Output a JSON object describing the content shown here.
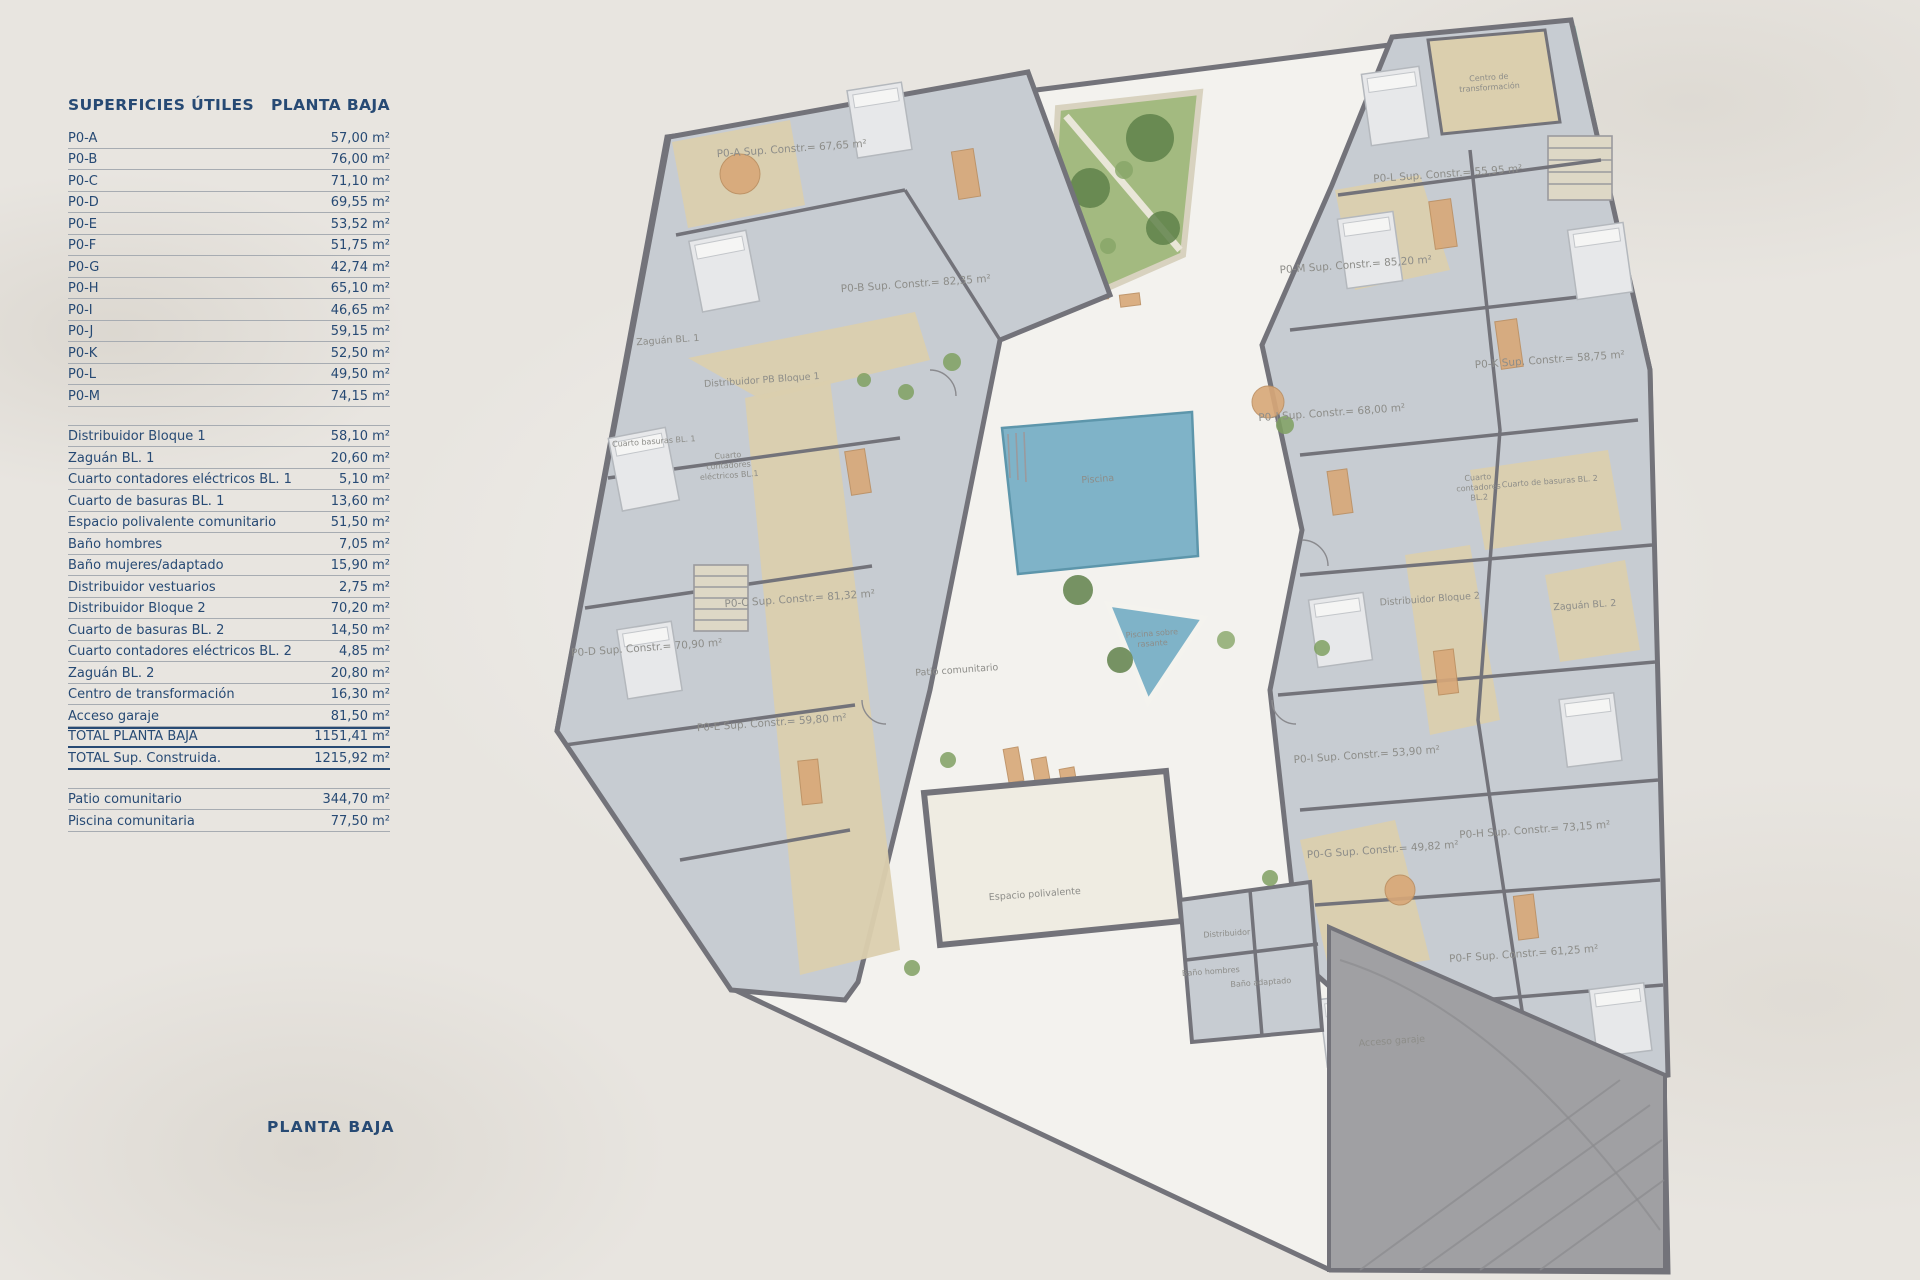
{
  "panel": {
    "title": "SUPERFICIES ÚTILES",
    "subtitle": "PLANTA BAJA",
    "apartments": [
      {
        "label": "P0-A",
        "value": "57,00 m²"
      },
      {
        "label": "P0-B",
        "value": "76,00 m²"
      },
      {
        "label": "P0-C",
        "value": "71,10 m²"
      },
      {
        "label": "P0-D",
        "value": "69,55 m²"
      },
      {
        "label": "P0-E",
        "value": "53,52 m²"
      },
      {
        "label": "P0-F",
        "value": "51,75 m²"
      },
      {
        "label": "P0-G",
        "value": "42,74 m²"
      },
      {
        "label": "P0-H",
        "value": "65,10 m²"
      },
      {
        "label": "P0-I",
        "value": "46,65 m²"
      },
      {
        "label": "P0-J",
        "value": "59,15 m²"
      },
      {
        "label": "P0-K",
        "value": "52,50 m²"
      },
      {
        "label": "P0-L",
        "value": "49,50 m²"
      },
      {
        "label": "P0-M",
        "value": "74,15 m²"
      }
    ],
    "common": [
      {
        "label": "Distribuidor Bloque 1",
        "value": "58,10 m²"
      },
      {
        "label": "Zaguán BL. 1",
        "value": "20,60 m²"
      },
      {
        "label": "Cuarto contadores eléctricos BL. 1",
        "value": "5,10 m²"
      },
      {
        "label": "Cuarto de basuras BL. 1",
        "value": "13,60 m²"
      },
      {
        "label": "Espacio polivalente comunitario",
        "value": "51,50 m²"
      },
      {
        "label": "Baño hombres",
        "value": "7,05 m²"
      },
      {
        "label": "Baño mujeres/adaptado",
        "value": "15,90 m²"
      },
      {
        "label": "Distribuidor vestuarios",
        "value": "2,75 m²"
      },
      {
        "label": "Distribuidor Bloque 2",
        "value": "70,20 m²"
      },
      {
        "label": "Cuarto de basuras BL. 2",
        "value": "14,50 m²"
      },
      {
        "label": "Cuarto contadores eléctricos BL. 2",
        "value": "4,85 m²"
      },
      {
        "label": "Zaguán BL. 2",
        "value": "20,80 m²"
      },
      {
        "label": "Centro de transformación",
        "value": "16,30 m²"
      },
      {
        "label": "Acceso garaje",
        "value": "81,50 m²"
      },
      {
        "label": "TOTAL PLANTA BAJA",
        "value": "1151,41 m²",
        "strong": true,
        "topline": true
      },
      {
        "label": "TOTAL Sup. Construida.",
        "value": "1215,92 m²",
        "strong": true
      }
    ],
    "outdoor": [
      {
        "label": "Patio comunitario",
        "value": "344,70 m²"
      },
      {
        "label": "Piscina comunitaria",
        "value": "77,50 m²"
      }
    ],
    "footer_title": "PLANTA BAJA"
  },
  "plan": {
    "colors": {
      "navy": "#274a74",
      "line": "#a7acb2",
      "wall": "#73737a",
      "room": "#c7ccd2",
      "corridor": "#dbcfae",
      "courtyard": "#f3f2ee",
      "garden": "#a3ba80",
      "palm": "#5f814a",
      "pool": "#7fb3c8",
      "pooldark": "#5d96ab",
      "ramp": "#a0a0a3",
      "furn": "#d8a878",
      "bed": "#e7e8ea",
      "label": "#8d8d89"
    },
    "labels": [
      {
        "text": "P0-A Sup. Constr.= 67,65 m²",
        "x": 792,
        "y": 152,
        "size": "m"
      },
      {
        "text": "P0-B Sup. Constr.= 82,35 m²",
        "x": 916,
        "y": 287,
        "size": "m"
      },
      {
        "text": "Zaguán BL. 1",
        "x": 668,
        "y": 343,
        "size": "s"
      },
      {
        "text": "Distribuidor PB Bloque 1",
        "x": 762,
        "y": 383,
        "size": "s"
      },
      {
        "text": "Cuarto basuras BL. 1",
        "x": 654,
        "y": 444,
        "size": "xs"
      },
      {
        "lines": [
          "Cuarto",
          "contadores",
          "eléctricos BL.1"
        ],
        "x": 728,
        "y": 458,
        "size": "xs"
      },
      {
        "text": "P0-C Sup. Constr.= 81,32 m²",
        "x": 800,
        "y": 602,
        "size": "m"
      },
      {
        "text": "P0-D Sup. Constr.= 70,90 m²",
        "x": 647,
        "y": 651,
        "size": "m"
      },
      {
        "text": "P0-E Sup. Constr.= 59,80 m²",
        "x": 772,
        "y": 726,
        "size": "m"
      },
      {
        "text": "Piscina",
        "x": 1098,
        "y": 482,
        "size": "s"
      },
      {
        "lines": [
          "Piscina sobre",
          "rasante"
        ],
        "x": 1152,
        "y": 636,
        "size": "xs"
      },
      {
        "text": "Patio comunitario",
        "x": 957,
        "y": 673,
        "size": "s"
      },
      {
        "text": "Espacio polivalente",
        "x": 1035,
        "y": 897,
        "size": "s"
      },
      {
        "text": "Distribuidor",
        "x": 1227,
        "y": 936,
        "size": "xs"
      },
      {
        "text": "Baño hombres",
        "x": 1211,
        "y": 974,
        "size": "xs"
      },
      {
        "text": "Baño adaptado",
        "x": 1261,
        "y": 985,
        "size": "xs"
      },
      {
        "text": "Acceso garaje",
        "x": 1392,
        "y": 1044,
        "size": "s"
      },
      {
        "lines": [
          "Centro de",
          "transformación"
        ],
        "x": 1489,
        "y": 80,
        "size": "xs"
      },
      {
        "text": "P0-L Sup. Constr.= 55,95 m²",
        "x": 1448,
        "y": 177,
        "size": "m"
      },
      {
        "text": "P0-M Sup. Constr.= 85,20 m²",
        "x": 1356,
        "y": 268,
        "size": "m"
      },
      {
        "text": "P0-K Sup. Constr.= 58,75 m²",
        "x": 1550,
        "y": 363,
        "size": "m"
      },
      {
        "text": "P0-J Sup. Constr.= 68,00 m²",
        "x": 1332,
        "y": 416,
        "size": "m"
      },
      {
        "text": "Cuarto de basuras BL. 2",
        "x": 1550,
        "y": 484,
        "size": "xs"
      },
      {
        "lines": [
          "Cuarto",
          "contadores",
          "BL.2"
        ],
        "x": 1478,
        "y": 480,
        "size": "xs"
      },
      {
        "text": "Distribuidor Bloque 2",
        "x": 1430,
        "y": 602,
        "size": "s"
      },
      {
        "text": "Zaguán BL. 2",
        "x": 1585,
        "y": 608,
        "size": "s"
      },
      {
        "text": "P0-I Sup. Constr.= 53,90 m²",
        "x": 1367,
        "y": 758,
        "size": "m"
      },
      {
        "text": "P0-G Sup. Constr.= 49,82 m²",
        "x": 1383,
        "y": 853,
        "size": "m"
      },
      {
        "text": "P0-H Sup. Constr.= 73,15 m²",
        "x": 1535,
        "y": 833,
        "size": "m"
      },
      {
        "text": "P0-F Sup. Constr.= 61,25 m²",
        "x": 1524,
        "y": 957,
        "size": "m"
      }
    ]
  }
}
